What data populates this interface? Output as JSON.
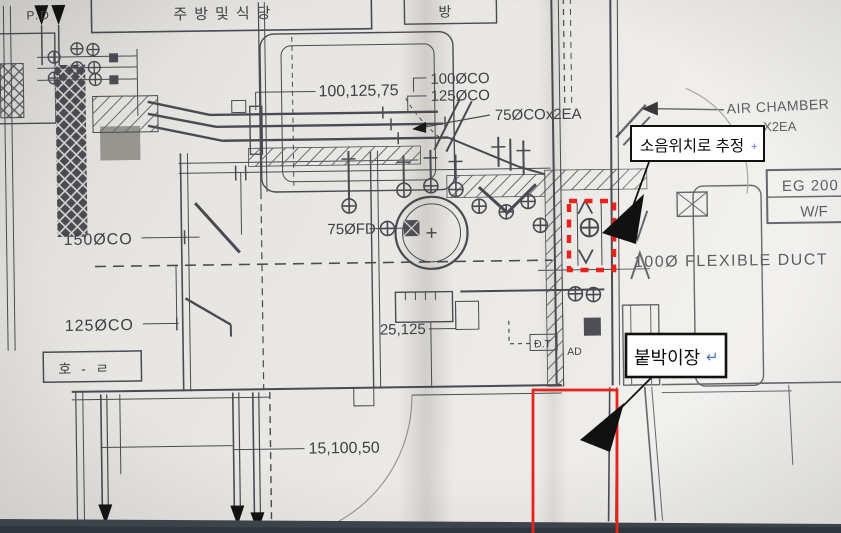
{
  "drawing_labels": {
    "pd": "P.D",
    "kitchen_room": "주방및식당",
    "bang_room": "방",
    "hall_room": "호 - ㄹ",
    "dim_top": "100,125,75",
    "co_100": "100ØCO",
    "co_125": "125ØCO",
    "co_75_2ea": "75ØCOx2EA",
    "air_chamber": "AIR CHAMBER",
    "air_chamber_qty": "X2EA",
    "eg_box_line1": "EG 200",
    "eg_box_line2": "W/F",
    "flexible_duct": "100Ø FLEXIBLE DUCT",
    "co_150": "150ØCO",
    "fd_75": "75ØFD",
    "co_125_lower": "125ØCO",
    "dim_mid": "25,125",
    "dim_bottom": "15,100,50",
    "duct_dt": "D.T",
    "duct_ad": "AD"
  },
  "annotations": {
    "noise_callout": {
      "text": "소음위치로 추정",
      "cursor": "+"
    },
    "closet_callout": {
      "text": "붙박이장",
      "cursor": "↵"
    }
  },
  "colors": {
    "highlight_red": "#e8231c",
    "annotation_black": "#111111",
    "cursor_blue": "#4a6fd4",
    "ink": "#4a4a52",
    "paper": "#e8e6e2"
  }
}
